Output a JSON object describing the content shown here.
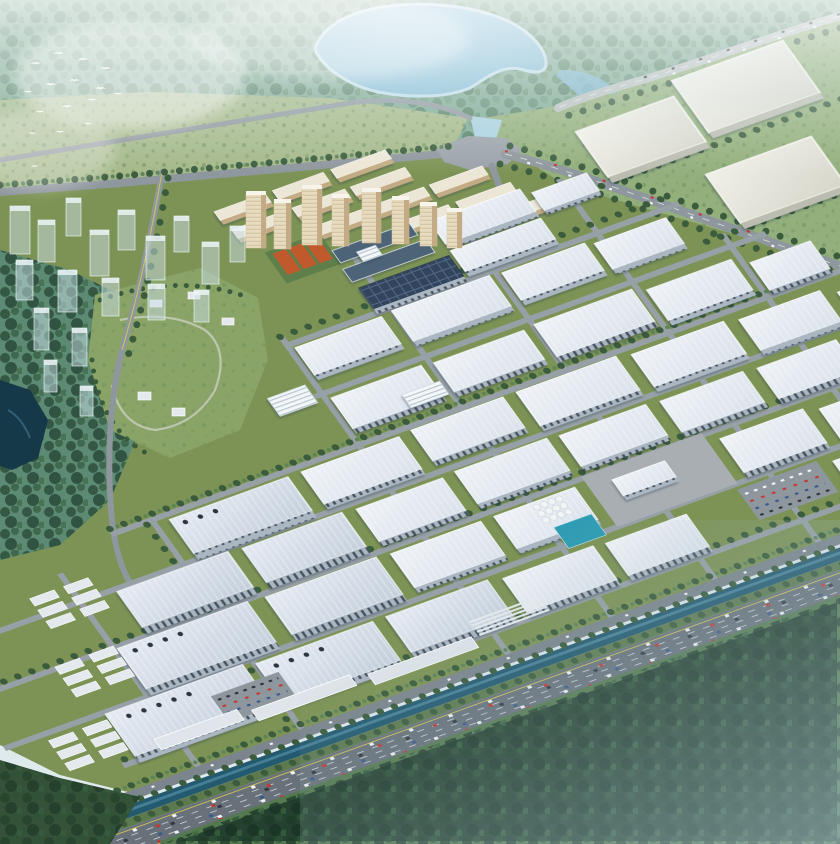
{
  "image": {
    "type": "aerial-architectural-rendering",
    "subject": "industrial park masterplan with residential quarter, lake, forest and highway",
    "view": "bird's-eye oblique",
    "width_px": 840,
    "height_px": 844,
    "visible_text": ""
  },
  "scene": {
    "bird_flock": {
      "count": 16,
      "color": "#ffffff"
    },
    "lake": {
      "position": "top-center"
    },
    "mega_factory_pads_northeast": {
      "count": 3
    },
    "scrub_fields": {
      "position": "upper-left"
    },
    "ghost_phase_towers": {
      "count": 18
    },
    "residential_quarter": {
      "high_rise_towers": 8,
      "slab_blocks": 13,
      "tennis_courts": 3
    },
    "school_campus": {
      "dark_roofs": 2
    },
    "solar_roof_plant": {
      "count": 1
    },
    "warehouse_grid": {
      "warehouses": 34,
      "large_factories": 9,
      "offices": 2,
      "small_sheds": 18
    },
    "hillside_park": {
      "villas": 5
    },
    "dark_pond": {
      "position": "left-edge"
    },
    "silo_cluster": {
      "silos": 12
    },
    "treatment_pond": {
      "count": 1
    },
    "parking_lots": {
      "count": 2
    },
    "canal": {
      "runs": "parallel to highway"
    },
    "highway": {
      "position": "bottom-right diagonal",
      "traffic": "dense"
    },
    "forest_south": {
      "haze": "blue mist lower-right"
    }
  },
  "palette": {
    "bg": "#dfeaec",
    "forestTop": "#7ea893",
    "forestTeal": "#5c8a72",
    "fieldGreen": "#93af7c",
    "scrub": "#a4b889",
    "scrubDot": "#6f9160",
    "lawn": "#7d9355",
    "lawnDark": "#5d7a4e",
    "parkGreen": "#8aa468",
    "lake": "#7db7d4",
    "lakeHi": "#9fcbe0",
    "lakeEdge": "#c2deea",
    "stream": "#a9d0e0",
    "pondDark": "#16394a",
    "pondTq": "#2f9cb3",
    "roadMajor": "#8e979d",
    "roadLight": "#b9c0bf",
    "roadMinor": "#9aa39f",
    "intersection": "#9aa2a9",
    "access": "#7c858d",
    "canal": "#235a70",
    "canalHi": "#5894aa",
    "highway": "#68717a",
    "laneYellow": "#d8ce4f",
    "laneWhite": "#e9edef",
    "roofA": "#eef2f7",
    "roofB": "#d9e1ea",
    "roofBigA": "#e4eaf2",
    "roofBigB": "#c4cfdb",
    "facade": "#aab6c2",
    "facadeWin": "#46525e",
    "lowrise": "#dfe5ea",
    "shed": "#e4e9ed",
    "pv": "#32455d",
    "pvLine": "#5d7492",
    "campusRoof": "#4d6377",
    "office": "#f4f7f9",
    "officeLine": "#aebfca",
    "cream": "#e7dcc0",
    "creamSh": "#c3ac85",
    "creamCap": "#f7f4ec",
    "courts": "#c05a2c",
    "courtGreen": "#5f7f4a",
    "ghost": "rgba(202,222,230,0.5)",
    "ghostEdge": "rgba(245,252,254,0.85)",
    "ghostCap": "rgba(238,246,249,0.8)",
    "pad": "#d6d6cb",
    "padEdge": "#f0f0e8",
    "padSide": "#bbbdb1",
    "apron": "#a9aeb3",
    "lot": "#8f979e",
    "tree": "#3a5c3d",
    "treeHi": "#5d8457",
    "forestDark": "#24402e",
    "forestDark2": "#345238",
    "silo": "#f2f5f6",
    "carWhite": "#f2f4f6",
    "carRed": "#c03a35",
    "carBlue": "#3a5a8c",
    "carDark": "#2f363e",
    "shadow": "rgba(30,50,70,0.3)",
    "mist": "rgba(255,255,255,0.85)",
    "haze": "rgba(140,172,182,0.5)"
  }
}
